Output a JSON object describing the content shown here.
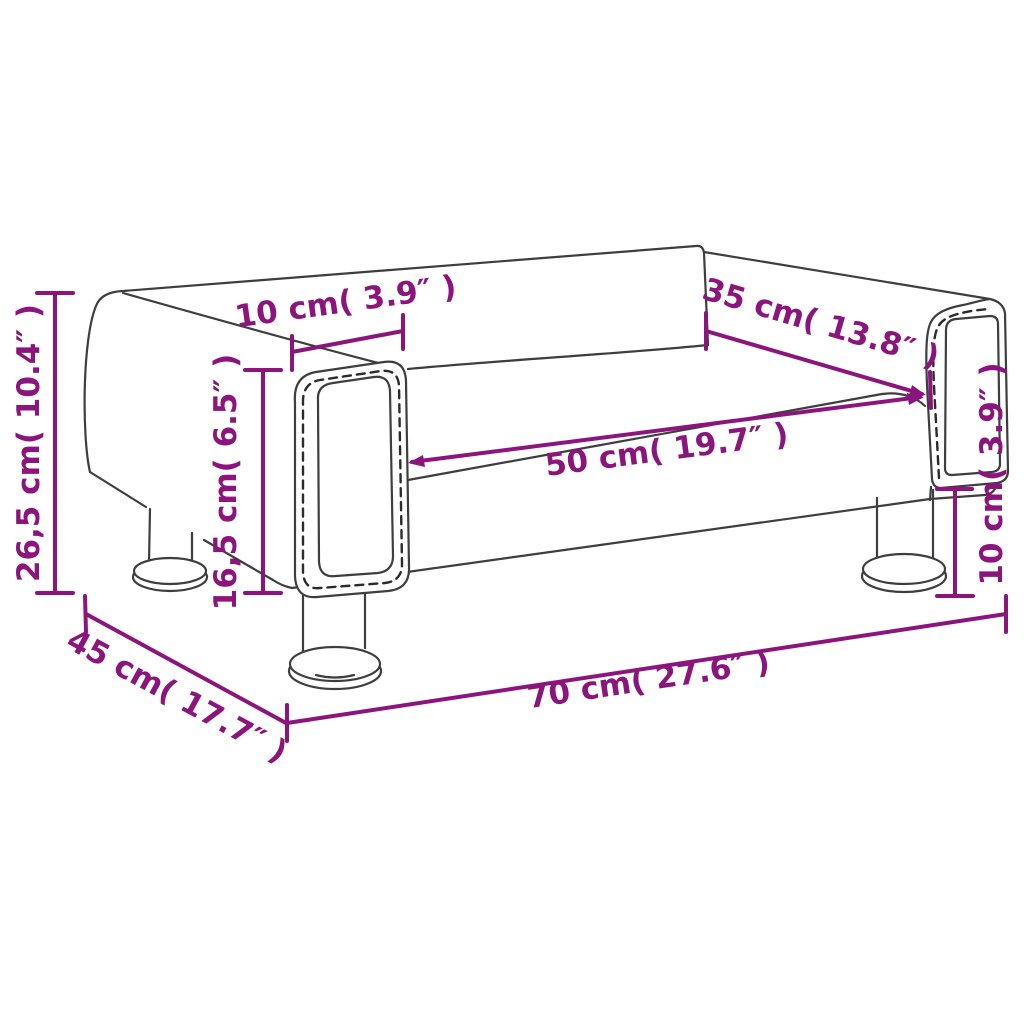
{
  "diagram": {
    "subject": "kids sofa dimension drawing",
    "colors": {
      "dimension_accent": "#8C147D",
      "outline_gray": "#3E3E3E",
      "background": "#FFFFFF"
    },
    "dimensions": {
      "overall_height": {
        "id": "overall-height",
        "label": "26,5 cm( 10.4″ )"
      },
      "seat_height": {
        "id": "seat-height",
        "label": "16,5 cm( 6.5″ )"
      },
      "armrest_width": {
        "id": "armrest-width",
        "label": "10 cm( 3.9″ )"
      },
      "backrest_width": {
        "id": "backrest-width",
        "label": "35 cm( 13.8″ )"
      },
      "seat_width": {
        "id": "seat-width",
        "label": "50 cm( 19.7″ )"
      },
      "leg_height": {
        "id": "leg-height",
        "label": "10 cm( 3.9″ )"
      },
      "depth": {
        "id": "depth",
        "label": "45 cm( 17.7″ )"
      },
      "overall_width": {
        "id": "overall-width",
        "label": "70 cm( 27.6″ )"
      }
    }
  }
}
